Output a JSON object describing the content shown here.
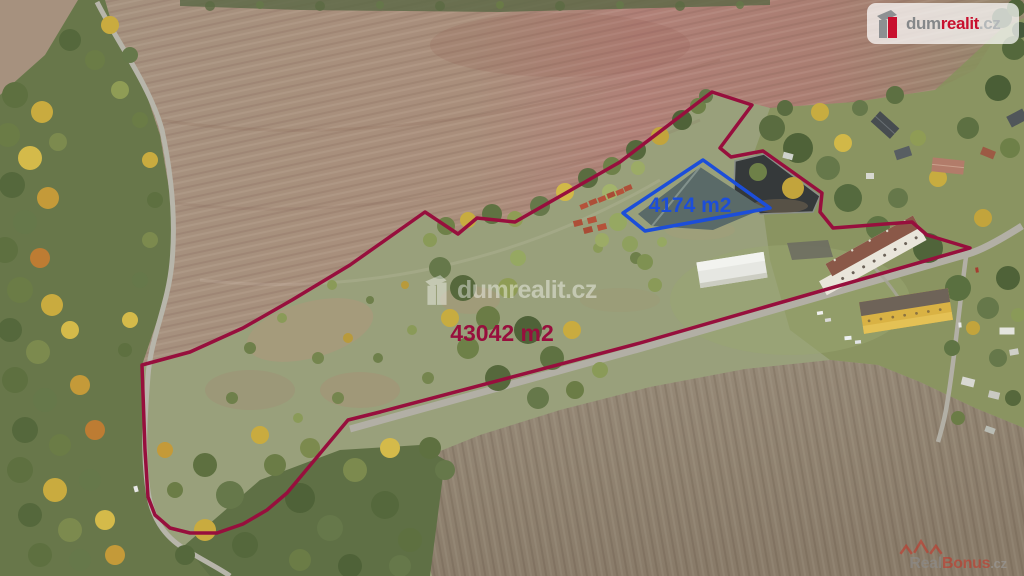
{
  "branding": {
    "logo": {
      "part_dum": "dum",
      "part_realit": "realit",
      "part_tld": ".cz",
      "brand_red": "#c8102e",
      "brand_gray": "#85888a"
    },
    "watermark": {
      "part_dum": "dum",
      "part_realit": "realit",
      "part_tld": ".cz"
    },
    "realbonus": {
      "part_real": "Real",
      "part_bonus": "Bonus",
      "part_tld": ".cz",
      "brand_red": "#c23a2c",
      "brand_gray": "#8c8c8c"
    }
  },
  "parcels": {
    "main": {
      "label": "43042 m2",
      "color": "#970f3d",
      "points": "712,92 752,105 720,148 731,157 763,151 822,193 820,212 833,228 912,222 927,235 970,248 640,343 380,412 348,420 287,493 267,510 243,524 217,533 190,533 170,528 155,515 148,497 145,450 142,365 190,352 243,328 292,300 350,265 425,212 458,234 477,218 515,222 620,162"
    },
    "pond": {
      "label": "4174 m2",
      "color": "#1c4ed9",
      "points": "703,160 770,208 645,231 623,213"
    }
  }
}
